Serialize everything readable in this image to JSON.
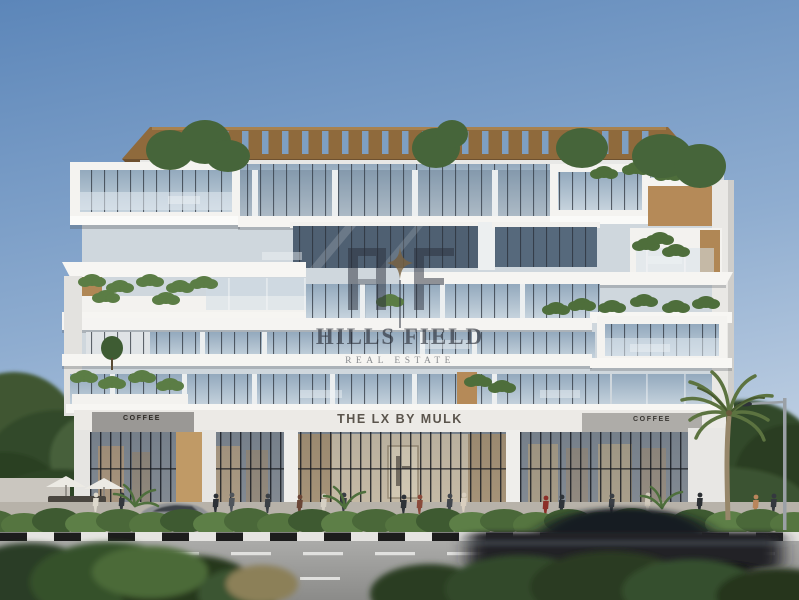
{
  "watermark": {
    "brand": "HILLS FIELD",
    "tagline": "REAL ESTATE",
    "monogram_letters": "HF"
  },
  "signage": {
    "entrance": "THE LX BY MULK",
    "coffee_left": "COFFEE",
    "coffee_right": "COFFEE"
  },
  "colors": {
    "sky_top": "#5c86b9",
    "sky_bottom": "#c8d6e6",
    "facade_white": "#f4f3f0",
    "wood_accent": "#b08755",
    "pergola_wood": "#8f6a3c",
    "greenery": "#4e6e3b",
    "glass": "#a9bfd0",
    "road": "#9b9b99",
    "watermark_text": "rgba(38,42,52,0.62)"
  }
}
